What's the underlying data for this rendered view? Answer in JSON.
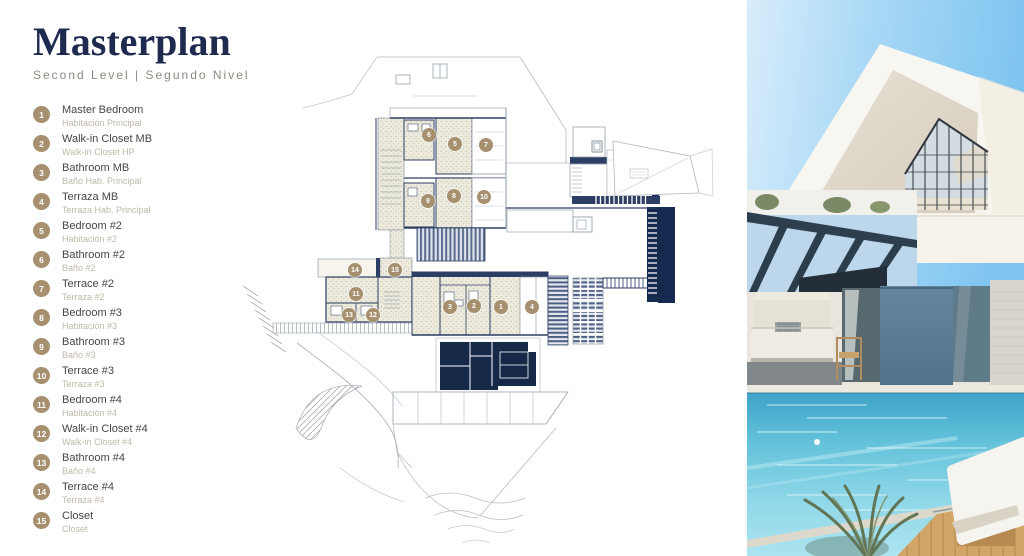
{
  "header": {
    "title": "Masterplan",
    "subtitle": "Second Level | Segundo Nivel"
  },
  "legend": {
    "items": [
      {
        "num": "1",
        "en": "Master Bedroom",
        "es": "Habitación Principal"
      },
      {
        "num": "2",
        "en": "Walk-in Closet MB",
        "es": "Walk-in Closet HP"
      },
      {
        "num": "3",
        "en": "Bathroom MB",
        "es": "Baño Hab. Principal"
      },
      {
        "num": "4",
        "en": "Terraza MB",
        "es": "Terraza Hab. Principal"
      },
      {
        "num": "5",
        "en": "Bedroom #2",
        "es": "Habitación #2"
      },
      {
        "num": "6",
        "en": "Bathroom #2",
        "es": "Baño #2"
      },
      {
        "num": "7",
        "en": "Terrace #2",
        "es": "Terraza #2"
      },
      {
        "num": "8",
        "en": "Bedroom #3",
        "es": "Habitación #3"
      },
      {
        "num": "9",
        "en": "Bathroom #3",
        "es": "Baño #3"
      },
      {
        "num": "10",
        "en": "Terrace #3",
        "es": "Terraza #3"
      },
      {
        "num": "11",
        "en": "Bedroom #4",
        "es": "Habitación #4"
      },
      {
        "num": "12",
        "en": "Walk-in Closet #4",
        "es": "Walk-in Closet #4"
      },
      {
        "num": "13",
        "en": "Bathroom #4",
        "es": "Baño #4"
      },
      {
        "num": "14",
        "en": "Terrace #4",
        "es": "Terraza #4"
      },
      {
        "num": "15",
        "en": "Closet",
        "es": "Closet"
      }
    ]
  },
  "plan": {
    "markers": [
      {
        "n": "1",
        "x": 501,
        "y": 307
      },
      {
        "n": "2",
        "x": 474,
        "y": 306
      },
      {
        "n": "3",
        "x": 450,
        "y": 307
      },
      {
        "n": "4",
        "x": 532,
        "y": 307
      },
      {
        "n": "5",
        "x": 455,
        "y": 144
      },
      {
        "n": "6",
        "x": 429,
        "y": 135
      },
      {
        "n": "7",
        "x": 486,
        "y": 145
      },
      {
        "n": "8",
        "x": 454,
        "y": 196
      },
      {
        "n": "9",
        "x": 428,
        "y": 201
      },
      {
        "n": "10",
        "x": 484,
        "y": 197
      },
      {
        "n": "11",
        "x": 356,
        "y": 294
      },
      {
        "n": "12",
        "x": 373,
        "y": 315
      },
      {
        "n": "13",
        "x": 349,
        "y": 315
      },
      {
        "n": "14",
        "x": 355,
        "y": 270
      },
      {
        "n": "15",
        "x": 395,
        "y": 270
      }
    ]
  },
  "colors": {
    "navy": "#1e2b4e",
    "tan": "#a6906f",
    "plan_wall": "#2c3e63",
    "plan_fill": "#16294e",
    "water": "#63c2da"
  }
}
